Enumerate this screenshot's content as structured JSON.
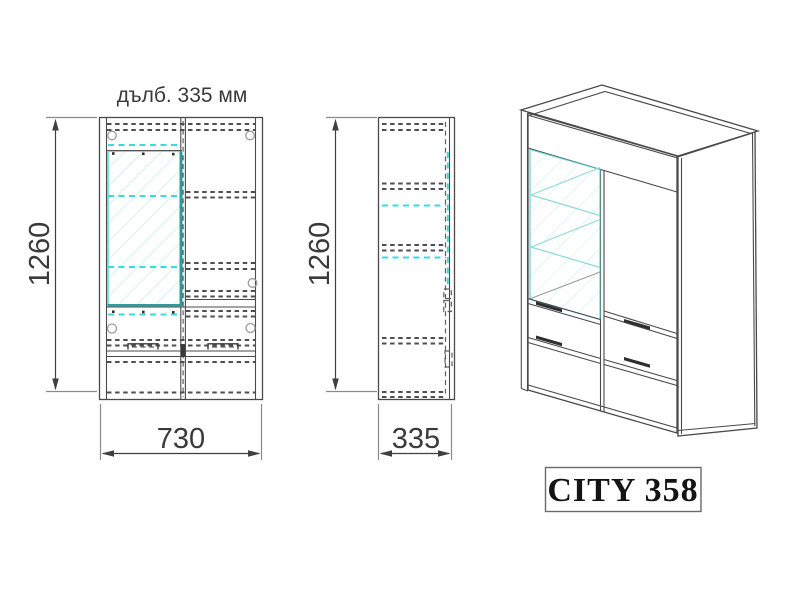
{
  "drawing": {
    "depth_label": "дълб. 335 мм",
    "model_label": "CITY 358",
    "front_view": {
      "height": "1260",
      "width": "730"
    },
    "side_view": {
      "height": "1260",
      "width": "335"
    }
  },
  "colors": {
    "line": "#474747",
    "hidden_line": "#4f4f4f",
    "glass_edge_teal": "#2f9b9b",
    "glass_shelf_cyan": "#38dcdc",
    "glass_hatch": "#bfeaea",
    "background": "#ffffff"
  }
}
